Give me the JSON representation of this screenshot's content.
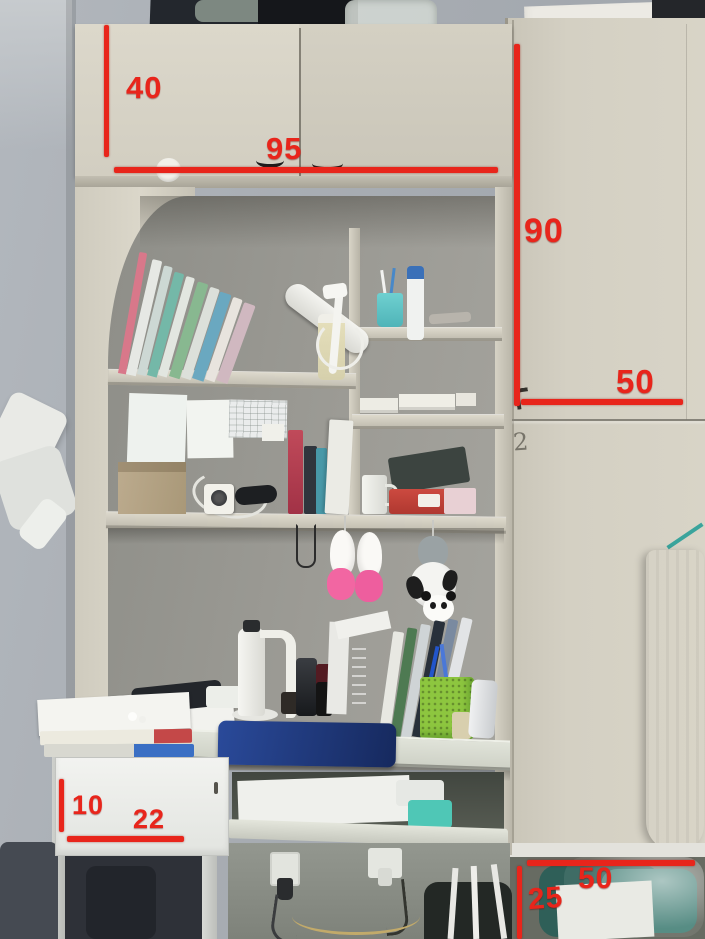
{
  "colors": {
    "annotation_red": "#e8251b",
    "wood_beige": "#d5d1c4",
    "wall_grey": "#a8adb3",
    "laptop_blue": "#1d3d8c",
    "organizer_green": "#8dc63f",
    "cup_teal": "#5cc4c8",
    "toy_pink": "#f266a2"
  },
  "dims": {
    "cabinet_height": "40",
    "cabinet_width": "95",
    "wardrobe_height": "90",
    "wardrobe_width": "50",
    "drawer_height": "10",
    "drawer_depth": "22",
    "bottom_height": "25",
    "bottom_width": "50"
  },
  "markings": {
    "door_number": "2"
  }
}
